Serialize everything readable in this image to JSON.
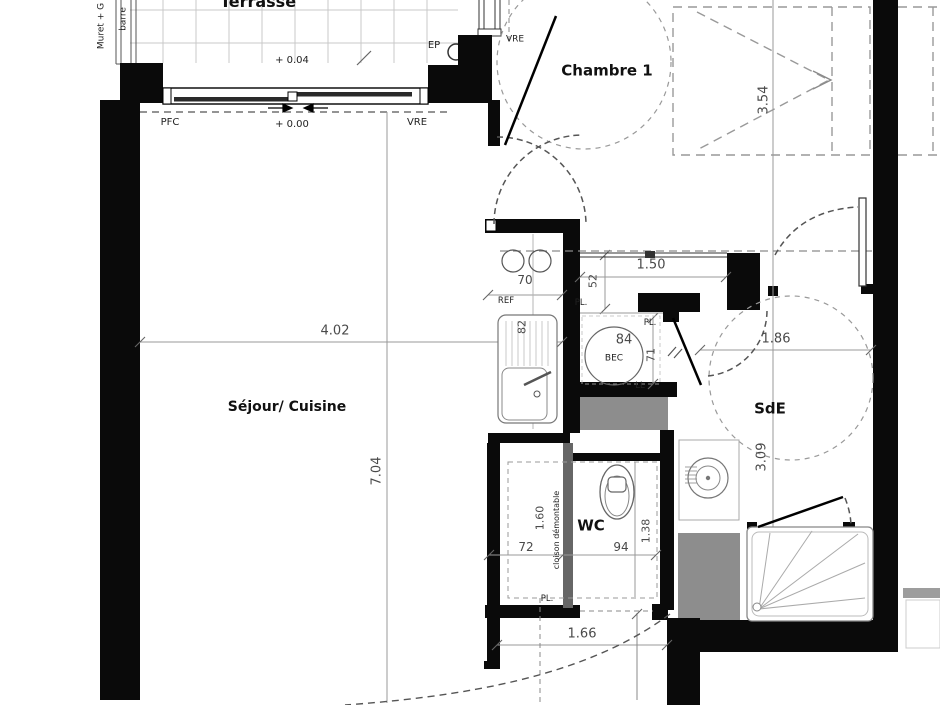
{
  "plan": {
    "rooms": {
      "terrasse": "Terrasse",
      "chambre1": "Chambre 1",
      "sejour_cuisine": "Séjour/ Cuisine",
      "wc": "WC",
      "sde": "SdE"
    },
    "levels": {
      "terrace_level": "+ 0.04",
      "floor_level": "+ 0.00"
    },
    "annotations": {
      "pfc": "PFC",
      "vre_bay": "VRE",
      "vre_window": "VRE",
      "ep": "EP",
      "ref": "REF",
      "bec": "BEC",
      "ll": "LL",
      "pl_placard": "PL.",
      "pl_bec": "PL.",
      "pl_wc": "PL.",
      "cloison": "cloison démontable",
      "muret": "Muret + G",
      "barreaudage": "barre"
    },
    "dimensions": {
      "sejour_width": "4.02",
      "sejour_height": "7.04",
      "chambre_width": "3.54",
      "placard_width": "1.50",
      "placard_depth": "52",
      "kitchen_width": "70",
      "sink_width": "82",
      "bec_width": "84",
      "bec_height": "71",
      "sde_width": "1.86",
      "sde_height": "3.09",
      "wc_left_width": "72",
      "wc_height": "1.60",
      "wc_right_width": "94",
      "wc_right_height": "1.38",
      "entry_width": "1.66"
    }
  }
}
